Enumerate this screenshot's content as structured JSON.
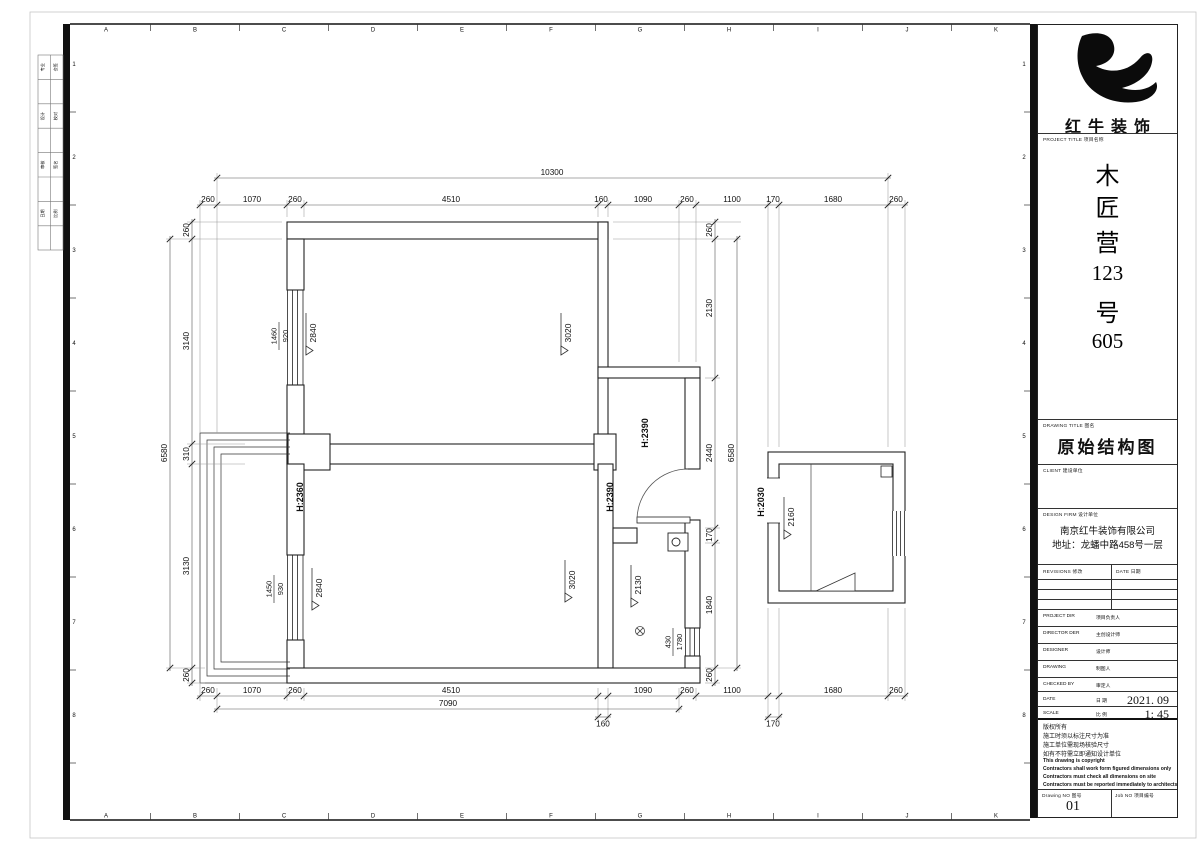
{
  "sheet": {
    "grid_letters": [
      "A",
      "B",
      "C",
      "D",
      "E",
      "F",
      "G",
      "H",
      "I",
      "J",
      "K"
    ],
    "grid_numbers": [
      "1",
      "2",
      "3",
      "4",
      "5",
      "6",
      "7",
      "8"
    ],
    "stamp_rows": [
      [
        "专业",
        "会签"
      ],
      [
        "设计",
        "校对"
      ],
      [
        "审核",
        "签名"
      ],
      [
        "日期",
        "比例"
      ]
    ]
  },
  "titleblock": {
    "brand": "红牛装饰",
    "project_label": "PROJECT TITLE  项目名称",
    "project_name_chars": [
      "木",
      "匠",
      "营",
      "123",
      "号",
      "605"
    ],
    "drawing_title_label": "DRAWING TITLE  图名",
    "drawing_title": "原始结构图",
    "client_label": "CLIENT  建设单位",
    "design_firm_label": "DESIGN FIRM  设计单位",
    "design_firm_name": "南京红牛装饰有限公司",
    "design_firm_addr": "地址：龙蟠中路458号一层",
    "revisions_label": "REVISIONS  修改",
    "revisions_date_label": "DATE  日期",
    "rows": [
      {
        "en": "PROJECT DIR",
        "cn": "项目负责人",
        "val": ""
      },
      {
        "en": "DIRECTOR DER",
        "cn": "主创设计师",
        "val": ""
      },
      {
        "en": "DESIGNER",
        "cn": "设计师",
        "val": ""
      },
      {
        "en": "DRAWING",
        "cn": "制图人",
        "val": ""
      },
      {
        "en": "CHECKED BY",
        "cn": "审定人",
        "val": ""
      },
      {
        "en": "DATE",
        "cn": "日  期",
        "val": "2021. 09"
      },
      {
        "en": "SCALE",
        "cn": "比  例",
        "val": "1:  45"
      }
    ],
    "notes_cn": [
      "版权所有",
      "施工时须以标注尺寸为准",
      "施工单位需现场核验尺寸",
      "如有不符需立即通知设计单位"
    ],
    "notes_en": [
      "This drawing is copyright",
      "Contractors shall work form figured dimensions only",
      "Contractors must check all dimensions on site",
      "Contractors must be reported immediately to architects"
    ],
    "drawing_no_label": "Drawing NO  图号",
    "drawing_no": "01",
    "job_no_label": "Job NO  项目编号"
  },
  "plan": {
    "dims": [
      {
        "o": "h",
        "p": 178,
        "b": [
          217,
          888
        ],
        "l": [
          [
            "10300",
            552,
            0
          ]
        ]
      },
      {
        "o": "h",
        "p": 205,
        "b": [
          200,
          217,
          287,
          304,
          598,
          608,
          679,
          696,
          768,
          779,
          888,
          905
        ],
        "l": [
          [
            "260",
            208,
            0
          ],
          [
            "1070",
            252,
            0
          ],
          [
            "260",
            295,
            0
          ],
          [
            "4510",
            451,
            0
          ],
          [
            "160",
            601,
            0
          ],
          [
            "1090",
            643,
            0
          ],
          [
            "260",
            687,
            0
          ],
          [
            "1100",
            732,
            0
          ],
          [
            "170",
            773,
            0
          ],
          [
            "1680",
            833,
            0
          ],
          [
            "260",
            896,
            0
          ]
        ]
      },
      {
        "o": "h",
        "p": 696,
        "b": [
          200,
          217,
          287,
          304,
          598,
          608,
          679,
          696,
          768,
          779,
          888,
          905
        ],
        "l": [
          [
            "260",
            208,
            0
          ],
          [
            "1070",
            252,
            0
          ],
          [
            "260",
            295,
            0
          ],
          [
            "4510",
            451,
            0
          ],
          [
            "1090",
            643,
            0
          ],
          [
            "260",
            687,
            0
          ],
          [
            "1100",
            732,
            0
          ],
          [
            "1680",
            833,
            0
          ],
          [
            "260",
            896,
            0
          ]
        ]
      },
      {
        "o": "h",
        "p": 709,
        "b": [
          217,
          679
        ],
        "l": [
          [
            "7090",
            448,
            0
          ]
        ]
      },
      {
        "o": "h",
        "p": 717,
        "b": [
          598,
          608
        ],
        "l": [
          [
            "160",
            603,
            1
          ]
        ]
      },
      {
        "o": "h",
        "p": 717,
        "b": [
          768,
          779
        ],
        "l": [
          [
            "170",
            773,
            1
          ]
        ]
      },
      {
        "o": "v",
        "p": 192,
        "b": [
          222,
          239,
          444,
          464,
          668,
          683
        ],
        "l": [
          [
            "260",
            230,
            0
          ],
          [
            "3140",
            341,
            0
          ],
          [
            "310",
            454,
            0
          ],
          [
            "3130",
            566,
            0
          ],
          [
            "260",
            675,
            0
          ]
        ]
      },
      {
        "o": "v",
        "p": 170,
        "b": [
          239,
          668
        ],
        "l": [
          [
            "6580",
            453,
            0
          ]
        ]
      },
      {
        "o": "v",
        "p": 715,
        "b": [
          222,
          239,
          378,
          528,
          543,
          668,
          683
        ],
        "l": [
          [
            "260",
            230,
            0
          ],
          [
            "2130",
            308,
            0
          ],
          [
            "2440",
            453,
            0
          ],
          [
            "170",
            535,
            0
          ],
          [
            "1840",
            605,
            0
          ],
          [
            "260",
            675,
            0
          ]
        ]
      },
      {
        "o": "v",
        "p": 737,
        "b": [
          239,
          668
        ],
        "l": [
          [
            "6580",
            453,
            0
          ]
        ]
      }
    ],
    "ext": [
      [
        200,
        433,
        200,
        200
      ],
      [
        217,
        433,
        217,
        173
      ],
      [
        287,
        217,
        287,
        200
      ],
      [
        304,
        217,
        304,
        200
      ],
      [
        598,
        217,
        598,
        200
      ],
      [
        608,
        217,
        608,
        200
      ],
      [
        679,
        362,
        679,
        200
      ],
      [
        696,
        362,
        696,
        200
      ],
      [
        768,
        447,
        768,
        200
      ],
      [
        779,
        447,
        779,
        200
      ],
      [
        888,
        447,
        888,
        173
      ],
      [
        905,
        447,
        905,
        200
      ],
      [
        200,
        683,
        200,
        701
      ],
      [
        217,
        688,
        217,
        713
      ],
      [
        287,
        688,
        287,
        701
      ],
      [
        304,
        688,
        304,
        701
      ],
      [
        598,
        688,
        598,
        722
      ],
      [
        608,
        688,
        608,
        722
      ],
      [
        679,
        688,
        679,
        713
      ],
      [
        696,
        688,
        696,
        701
      ],
      [
        768,
        608,
        768,
        722
      ],
      [
        779,
        608,
        779,
        722
      ],
      [
        888,
        608,
        888,
        701
      ],
      [
        905,
        608,
        905,
        701
      ],
      [
        282,
        222,
        187,
        222
      ],
      [
        282,
        239,
        166,
        239
      ],
      [
        245,
        444,
        187,
        444
      ],
      [
        245,
        464,
        187,
        464
      ],
      [
        205,
        668,
        166,
        668
      ],
      [
        205,
        683,
        187,
        683
      ],
      [
        613,
        222,
        741,
        222
      ],
      [
        613,
        239,
        741,
        239
      ],
      [
        705,
        378,
        720,
        378
      ],
      [
        705,
        528,
        720,
        528
      ],
      [
        705,
        543,
        720,
        543
      ],
      [
        705,
        668,
        741,
        668
      ],
      [
        705,
        683,
        720,
        683
      ]
    ],
    "levels": [
      {
        "t": "2840",
        "x": 316,
        "y": 335
      },
      {
        "t": "3020",
        "x": 571,
        "y": 335
      },
      {
        "t": "2840",
        "x": 322,
        "y": 590
      },
      {
        "t": "3020",
        "x": 575,
        "y": 582
      },
      {
        "t": "2130",
        "x": 641,
        "y": 587
      },
      {
        "t": "2160",
        "x": 794,
        "y": 519
      }
    ],
    "heights": [
      {
        "t": "H:2390",
        "x": 648,
        "y": 433
      },
      {
        "t": "H:2390",
        "x": 613,
        "y": 497
      },
      {
        "t": "H:2360",
        "x": 303,
        "y": 497
      },
      {
        "t": "H:2030",
        "x": 764,
        "y": 502
      }
    ],
    "windows": [
      {
        "a": "1460",
        "b": "920",
        "x": 279,
        "y": 336
      },
      {
        "a": "1450",
        "b": "930",
        "x": 274,
        "y": 589
      },
      {
        "a": "430",
        "b": "1780",
        "x": 673,
        "y": 642
      }
    ]
  }
}
